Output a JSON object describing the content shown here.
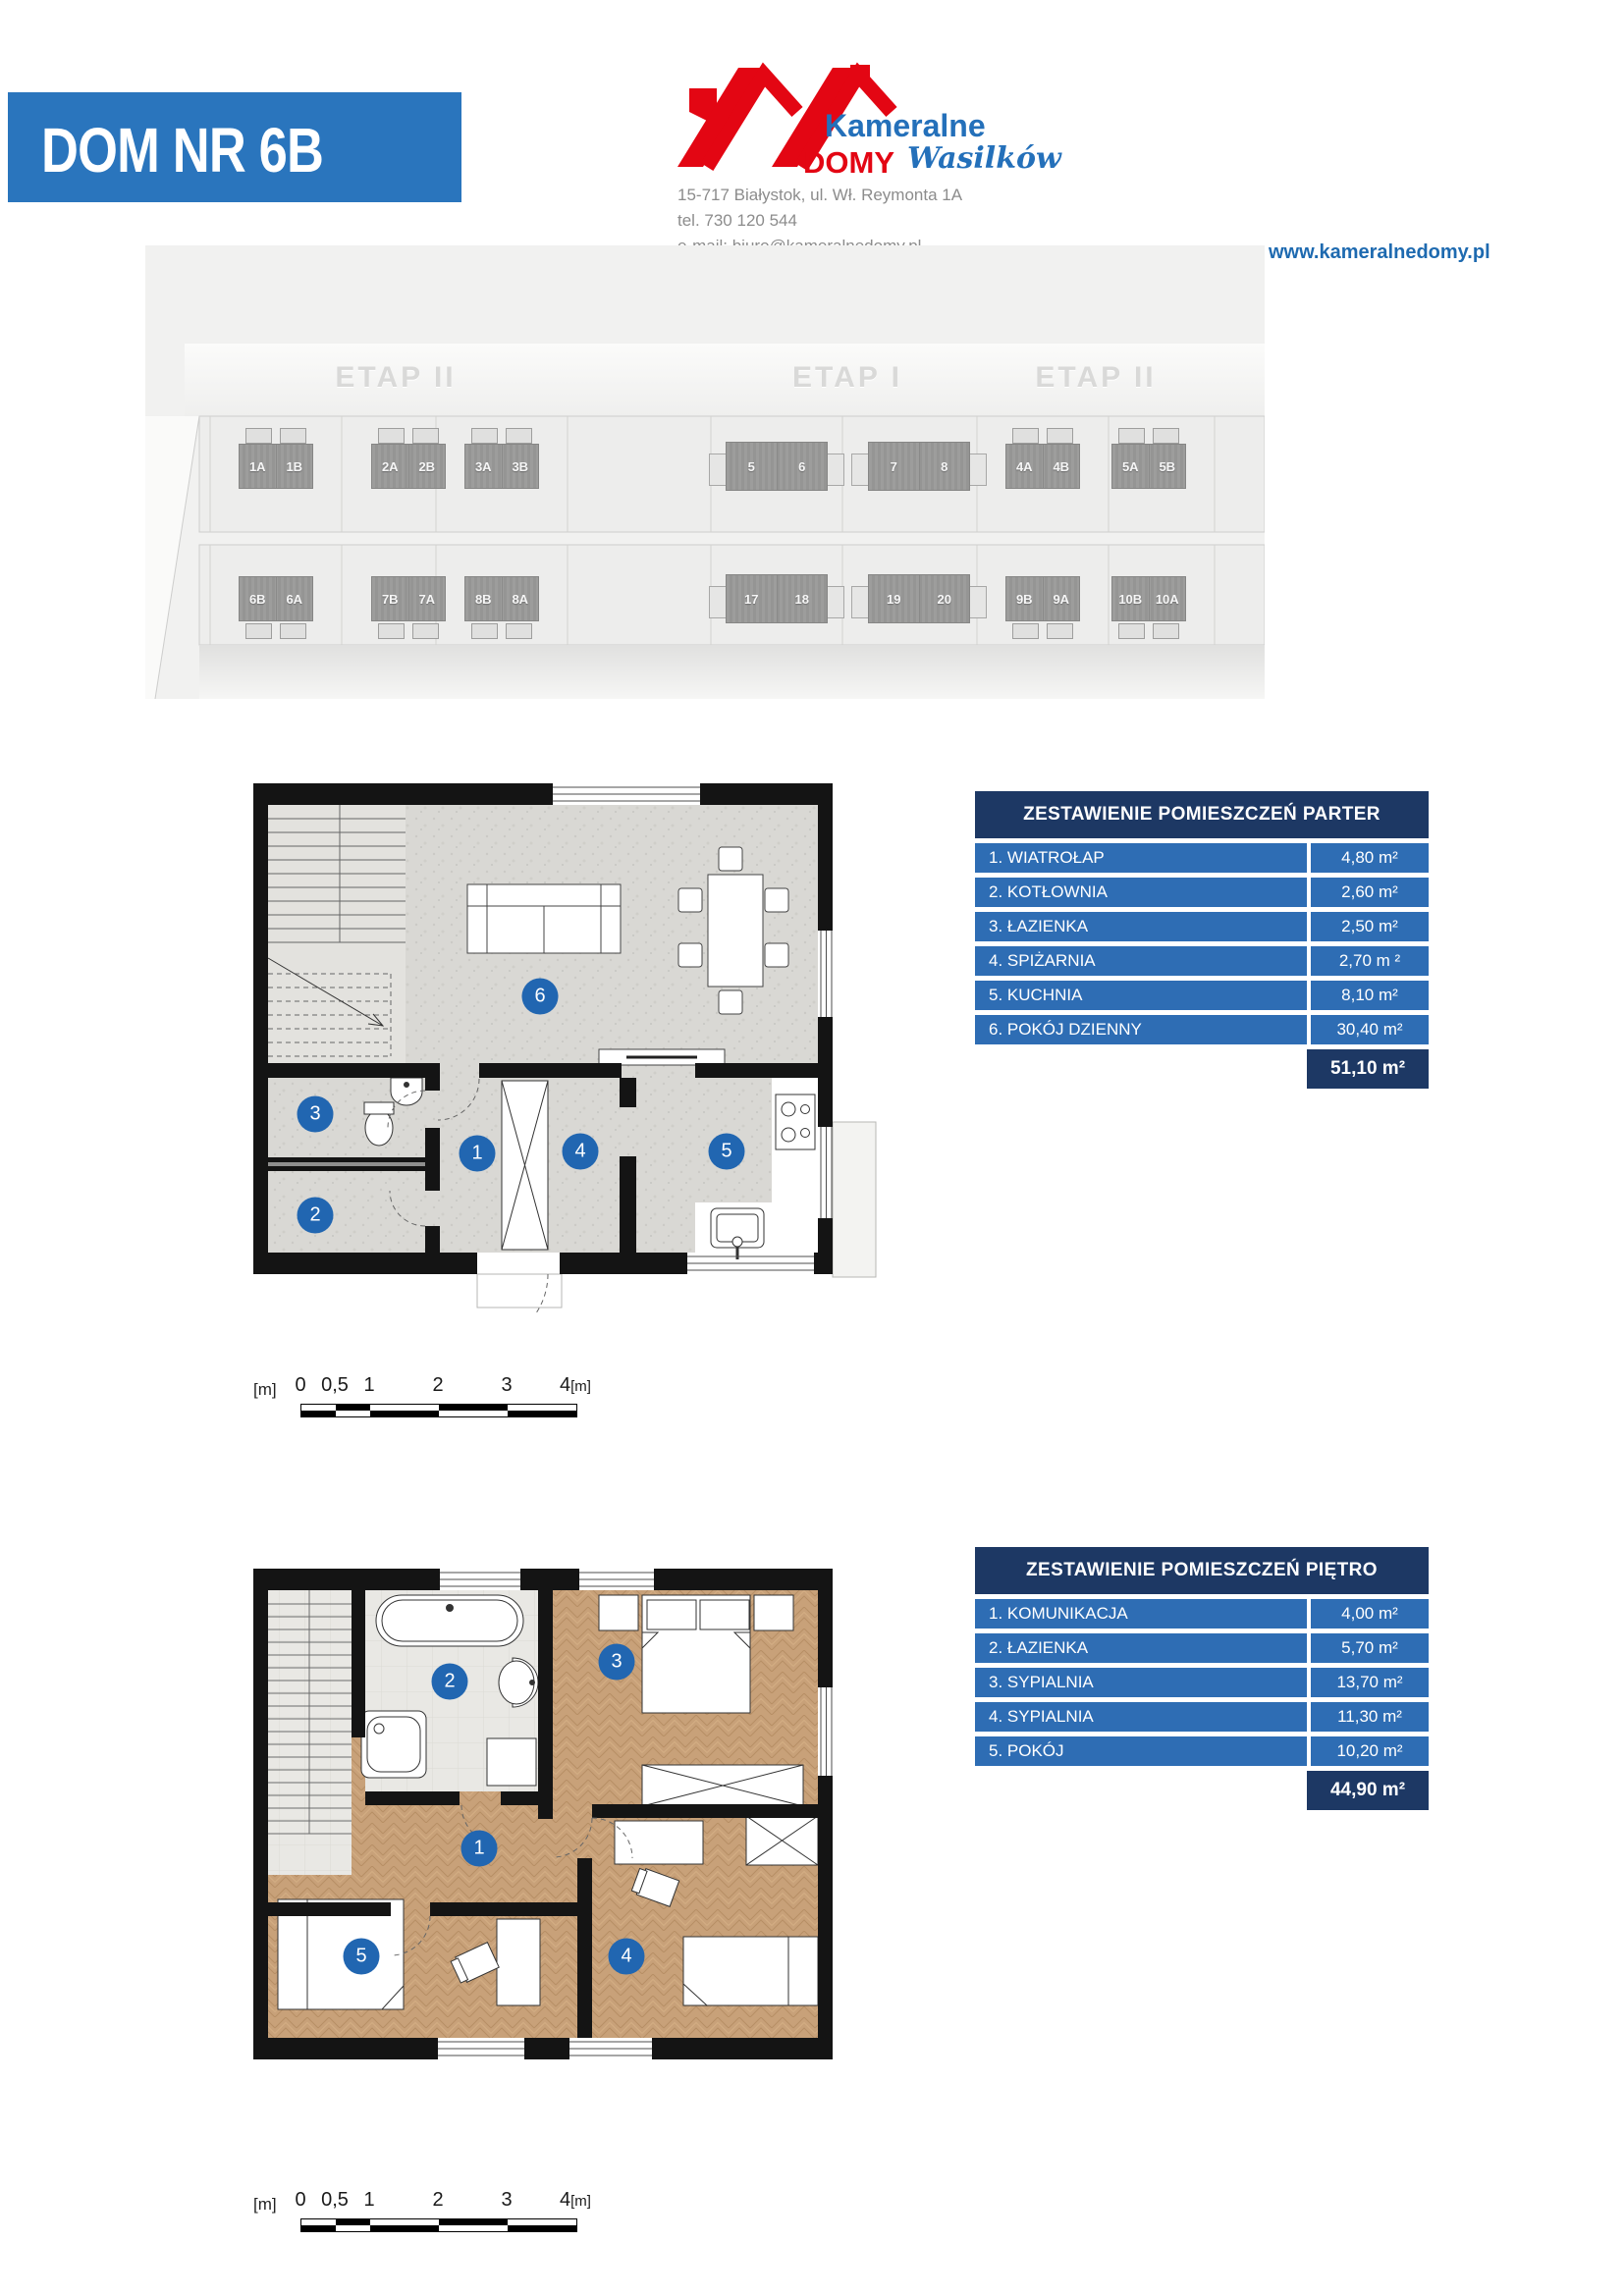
{
  "page": {
    "title": "DOM NR 6B"
  },
  "header": {
    "logo": {
      "brand_line1": "Kameralne",
      "brand_line2": "DOMY",
      "brand_location": "Wasilków"
    },
    "contact": {
      "address": "15-717 Białystok, ul. Wł. Reymonta 1A",
      "phone": "tel. 730 120 544",
      "email": "e-mail: biuro@kameralnedomy.pl"
    },
    "website": "www.kameralnedomy.pl"
  },
  "site_plan": {
    "stage_labels": [
      "ETAP II",
      "ETAP I",
      "ETAP II"
    ],
    "top_row": [
      {
        "a": "1A",
        "b": "1B"
      },
      {
        "a": "2A",
        "b": "2B"
      },
      {
        "a": "3A",
        "b": "3B"
      },
      {
        "a": "5",
        "b": "6"
      },
      {
        "a": "7",
        "b": "8"
      },
      {
        "a": "4A",
        "b": "4B"
      },
      {
        "a": "5A",
        "b": "5B"
      }
    ],
    "bottom_row": [
      {
        "a": "6B",
        "b": "6A"
      },
      {
        "a": "7B",
        "b": "7A"
      },
      {
        "a": "8B",
        "b": "8A"
      },
      {
        "a": "17",
        "b": "18"
      },
      {
        "a": "19",
        "b": "20"
      },
      {
        "a": "9B",
        "b": "9A"
      },
      {
        "a": "10B",
        "b": "10A"
      }
    ]
  },
  "ground_floor": {
    "table": {
      "title": "ZESTAWIENIE POMIESZCZEŃ PARTER",
      "rows": [
        {
          "label": "1. WIATROŁAP",
          "area": "4,80 m²"
        },
        {
          "label": "2. KOTŁOWNIA",
          "area": "2,60 m²"
        },
        {
          "label": "3. ŁAZIENKA",
          "area": "2,50 m²"
        },
        {
          "label": "4. SPIŻARNIA",
          "area": "2,70 m ²"
        },
        {
          "label": "5. KUCHNIA",
          "area": "8,10 m²"
        },
        {
          "label": "6. POKÓJ DZIENNY",
          "area": "30,40 m²"
        }
      ],
      "total": "51,10 m²"
    },
    "markers": [
      "1",
      "2",
      "3",
      "4",
      "5",
      "6"
    ]
  },
  "upper_floor": {
    "table": {
      "title": "ZESTAWIENIE POMIESZCZEŃ PIĘTRO",
      "rows": [
        {
          "label": "1. KOMUNIKACJA",
          "area": "4,00 m²"
        },
        {
          "label": "2. ŁAZIENKA",
          "area": "5,70 m²"
        },
        {
          "label": "3. SYPIALNIA",
          "area": "13,70 m²"
        },
        {
          "label": "4. SYPIALNIA",
          "area": "11,30 m²"
        },
        {
          "label": "5. POKÓJ",
          "area": "10,20 m²"
        }
      ],
      "total": "44,90 m²"
    },
    "markers": [
      "1",
      "2",
      "3",
      "4",
      "5"
    ]
  },
  "scale_bar": {
    "unit": "[m]",
    "labels": [
      "0",
      "0,5",
      "1",
      "2",
      "3",
      "4"
    ],
    "end_unit": "[m]"
  },
  "colors": {
    "banner_blue": "#2a75bd",
    "table_row_blue": "#2e6db4",
    "table_navy": "#1d3864",
    "logo_red": "#e30613",
    "logo_blue": "#2470ba",
    "marker_blue": "#2166b1",
    "website_blue": "#1e6ab0"
  }
}
